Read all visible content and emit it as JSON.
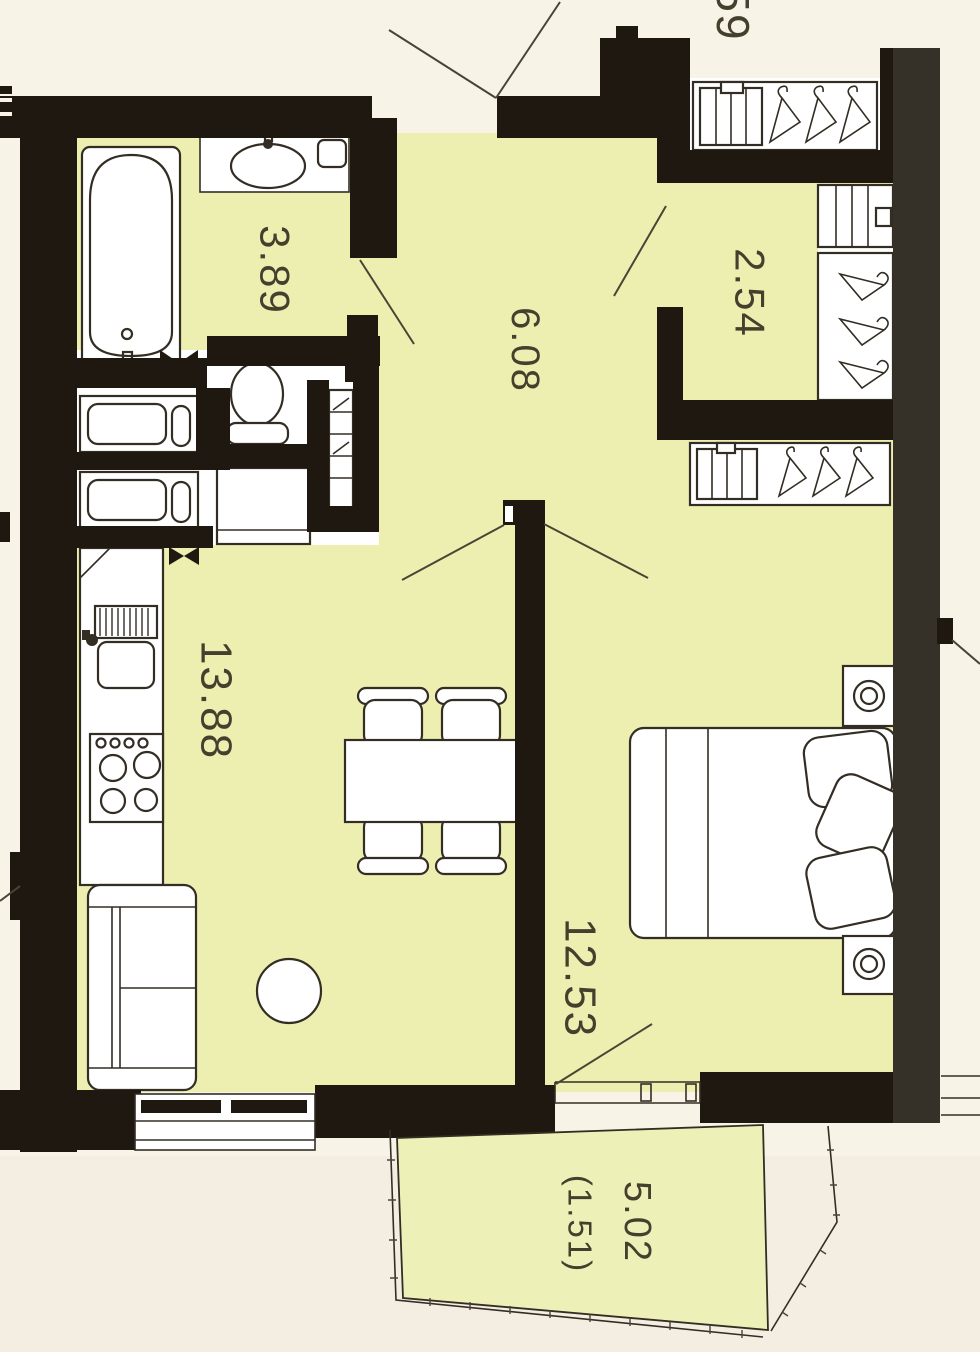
{
  "plan": {
    "colors": {
      "paper": "#f8f3e7",
      "floor": "#ecefb0",
      "balcony_floor": "#edf1b8",
      "wall": "#1e1811",
      "outer_wall_right": "#353028",
      "line": "#332d24",
      "label_text": "#45402e"
    },
    "rooms": {
      "bathroom": {
        "name": "bathroom",
        "area": "3.89"
      },
      "hallway": {
        "name": "hallway",
        "area": "6.08"
      },
      "closet": {
        "name": "closet",
        "area": "2.54"
      },
      "kitchen_living": {
        "name": "kitchen-living-room",
        "area": "13.88"
      },
      "bedroom": {
        "name": "bedroom",
        "area": "12.53"
      },
      "balcony": {
        "name": "balcony",
        "area": "5.02",
        "area_note": "(1.51)"
      }
    },
    "adjacent_unit": {
      "label": "59"
    },
    "fixtures": [
      "bathtub",
      "washbasin",
      "toilet",
      "washer",
      "washer-2",
      "shelf-unit",
      "kitchen-sink",
      "sink-drainer",
      "stove",
      "dining-table",
      "chairs",
      "sofa",
      "round-table",
      "double-bed",
      "pillows",
      "nightstand-lamps",
      "wardrobes",
      "hanger-icons",
      "door-swing-lines",
      "windows",
      "balcony-railing"
    ]
  }
}
